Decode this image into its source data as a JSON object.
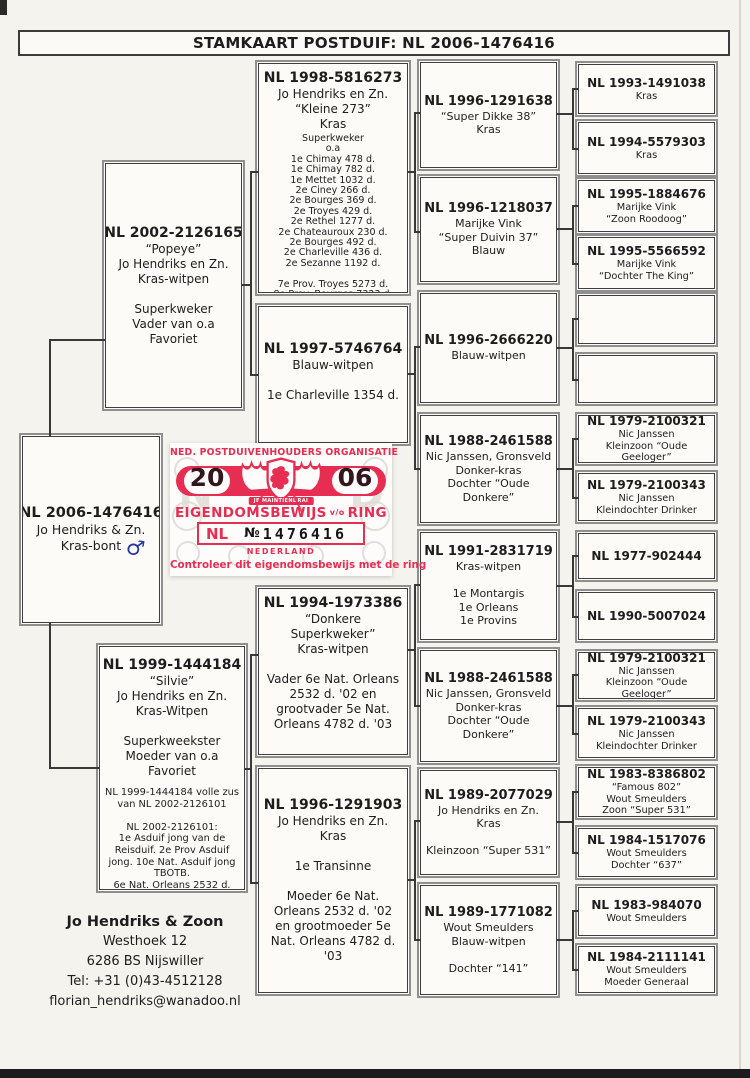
{
  "page": {
    "title": "STAMKAART POSTDUIF: NL 2006-1476416"
  },
  "pedigree": {
    "subject": {
      "ring": "NL 2006-1476416",
      "body": "Jo Hendriks & Zn.\nKras-bont",
      "sex": "♂"
    },
    "sire": {
      "ring": "NL 2002-2126165",
      "body": "“Popeye”\nJo Hendriks en Zn.\nKras-witpen\n\nSuperkweker\nVader van o.a\nFavoriet"
    },
    "dam": {
      "ring": "NL 1999-1444184",
      "body": "“Silvie”\nJo Hendriks en Zn.\nKras-Witpen\n\nSuperkweekster\nMoeder van o.a\nFavoriet",
      "small": "NL 1999-1444184 volle zus\nvan NL 2002-2126101\n\nNL 2002-2126101:\n1e Asduif jong van de\nReisduif. 2e Prov Asduif\njong. 10e Nat. Asduif jong\nTBOTB.\n6e Nat. Orleans 2532 d."
    },
    "grandparents": [
      {
        "ring": "NL 1998-5816273",
        "body": "Jo Hendriks en Zn.\n“Kleine 273”\nKras",
        "small": "Superkweker\no.a\n1e Chimay 478 d.\n1e Chimay 782 d.\n1e Mettet 1032 d.\n2e Ciney 266 d.\n2e Bourges 369 d.\n2e Troyes 429 d.\n2e Rethel 1277 d.\n2e Chateauroux 230 d.\n2e Bourges 492 d.\n2e Charleville 436 d.\n2e Sezanne 1192 d.\n\n7e Prov. Troyes 5273 d.\n8e Prov. Bourges 7323 d.\n12e Prov. Bourges 8231 d."
      },
      {
        "ring": "NL 1997-5746764",
        "body": "Blauw-witpen\n\n1e Charleville 1354 d."
      },
      {
        "ring": "NL 1994-1973386",
        "body": "“Donkere Superkweker”\nKras-witpen\n\nVader 6e Nat. Orleans\n2532 d. '02 en\ngrootvader 5e Nat.\nOrleans 4782 d. '03"
      },
      {
        "ring": "NL 1996-1291903",
        "body": "Jo Hendriks en Zn.\nKras\n\n1e Transinne\n\nMoeder 6e Nat.\nOrleans 2532 d. '02\nen grootmoeder 5e\nNat. Orleans 4782 d.\n'03"
      }
    ],
    "ggparents": [
      {
        "ring": "NL 1996-1291638",
        "body": "“Super Dikke 38”\nKras"
      },
      {
        "ring": "NL 1996-1218037",
        "body": "Marijke Vink\n“Super Duivin 37”\nBlauw"
      },
      {
        "ring": "NL 1996-2666220",
        "body": "Blauw-witpen"
      },
      {
        "ring": "NL 1988-2461588",
        "body": "Nic Janssen, Gronsveld\nDonker-kras\nDochter “Oude Donkere”"
      },
      {
        "ring": "NL 1991-2831719",
        "body": "Kras-witpen\n\n1e Montargis\n1e Orleans\n1e Provins"
      },
      {
        "ring": "NL 1988-2461588",
        "body": "Nic Janssen, Gronsveld\nDonker-kras\nDochter “Oude Donkere”"
      },
      {
        "ring": "NL 1989-2077029",
        "body": "Jo Hendriks en Zn.\nKras\n\nKleinzoon “Super 531”"
      },
      {
        "ring": "NL 1989-1771082",
        "body": "Wout Smeulders\nBlauw-witpen\n\nDochter “141”"
      }
    ],
    "gggparents": [
      {
        "ring": "NL 1993-1491038",
        "body": "Kras"
      },
      {
        "ring": "NL 1994-5579303",
        "body": "Kras"
      },
      {
        "ring": "NL 1995-1884676",
        "body": "Marijke Vink\n“Zoon Roodoog”"
      },
      {
        "ring": "NL 1995-5566592",
        "body": "Marijke Vink\n“Dochter The King”"
      },
      {
        "ring": "",
        "body": ""
      },
      {
        "ring": "",
        "body": ""
      },
      {
        "ring": "NL 1979-2100321",
        "body": "Nic Janssen\nKleinzoon “Oude Geeloger”"
      },
      {
        "ring": "NL 1979-2100343",
        "body": "Nic Janssen\nKleindochter Drinker"
      },
      {
        "ring": "NL 1977-902444",
        "body": ""
      },
      {
        "ring": "NL 1990-5007024",
        "body": ""
      },
      {
        "ring": "NL 1979-2100321",
        "body": "Nic Janssen\nKleinzoon “Oude Geeloger”"
      },
      {
        "ring": "NL 1979-2100343",
        "body": "Nic Janssen\nKleindochter Drinker"
      },
      {
        "ring": "NL 1983-8386802",
        "body": "“Famous 802”\nWout Smeulders\nZoon “Super 531”"
      },
      {
        "ring": "NL 1984-1517076",
        "body": "Wout Smeulders\nDochter “637”"
      },
      {
        "ring": "NL 1983-984070",
        "body": "Wout Smeulders"
      },
      {
        "ring": "NL 1984-2111141",
        "body": "Wout Smeulders\nMoeder Generaal"
      }
    ]
  },
  "certificate": {
    "org": "NED. POSTDUIVENHOUDERS ORGANISATIE",
    "year_left": "20",
    "year_right": "06",
    "motto": "JE MAINTIENDRAI",
    "title": "EIGENDOMSBEWIJS",
    "title_mid": "v/o",
    "title_end": "RING",
    "country_code": "NL",
    "number_sign": "№",
    "ring_number": "1476416",
    "country": "NEDERLAND",
    "footer": "Controleer dit eigendomsbewijs met de ring",
    "red": "#e72e52"
  },
  "contact": {
    "name": "Jo Hendriks & Zoon",
    "address1": "Westhoek 12",
    "address2": "6286 BS Nijswiller",
    "tel": "Tel: +31 (0)43-4512128",
    "email": "florian_hendriks@wanadoo.nl"
  }
}
